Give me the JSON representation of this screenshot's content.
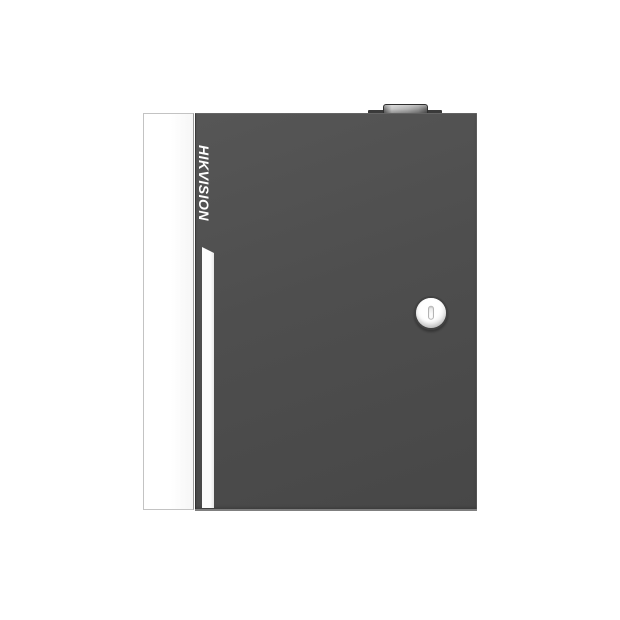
{
  "brand": {
    "logo_text": "HIKVISION"
  },
  "icons": {
    "lock": "keyhole-icon"
  },
  "colors": {
    "background": "#ffffff",
    "door_gray": "#4e4e4e",
    "door_gray_light": "#565656",
    "door_gray_dark": "#474747",
    "door_bottom_edge": "#8c8c8c",
    "hinge_band": "#3a3a3a",
    "knob_light": "#c4c4c4",
    "knob_dark": "#5c5c5c",
    "side_panel": "#ffffff",
    "panel_border": "#c3c3c3",
    "stripe_white": "#fcfcfc",
    "logo_white": "#ffffff",
    "lock_ring": "#424242",
    "lock_face_light": "#ffffff",
    "lock_face_dark": "#c9c9c9",
    "keyhole_border": "#b4b4b4"
  }
}
